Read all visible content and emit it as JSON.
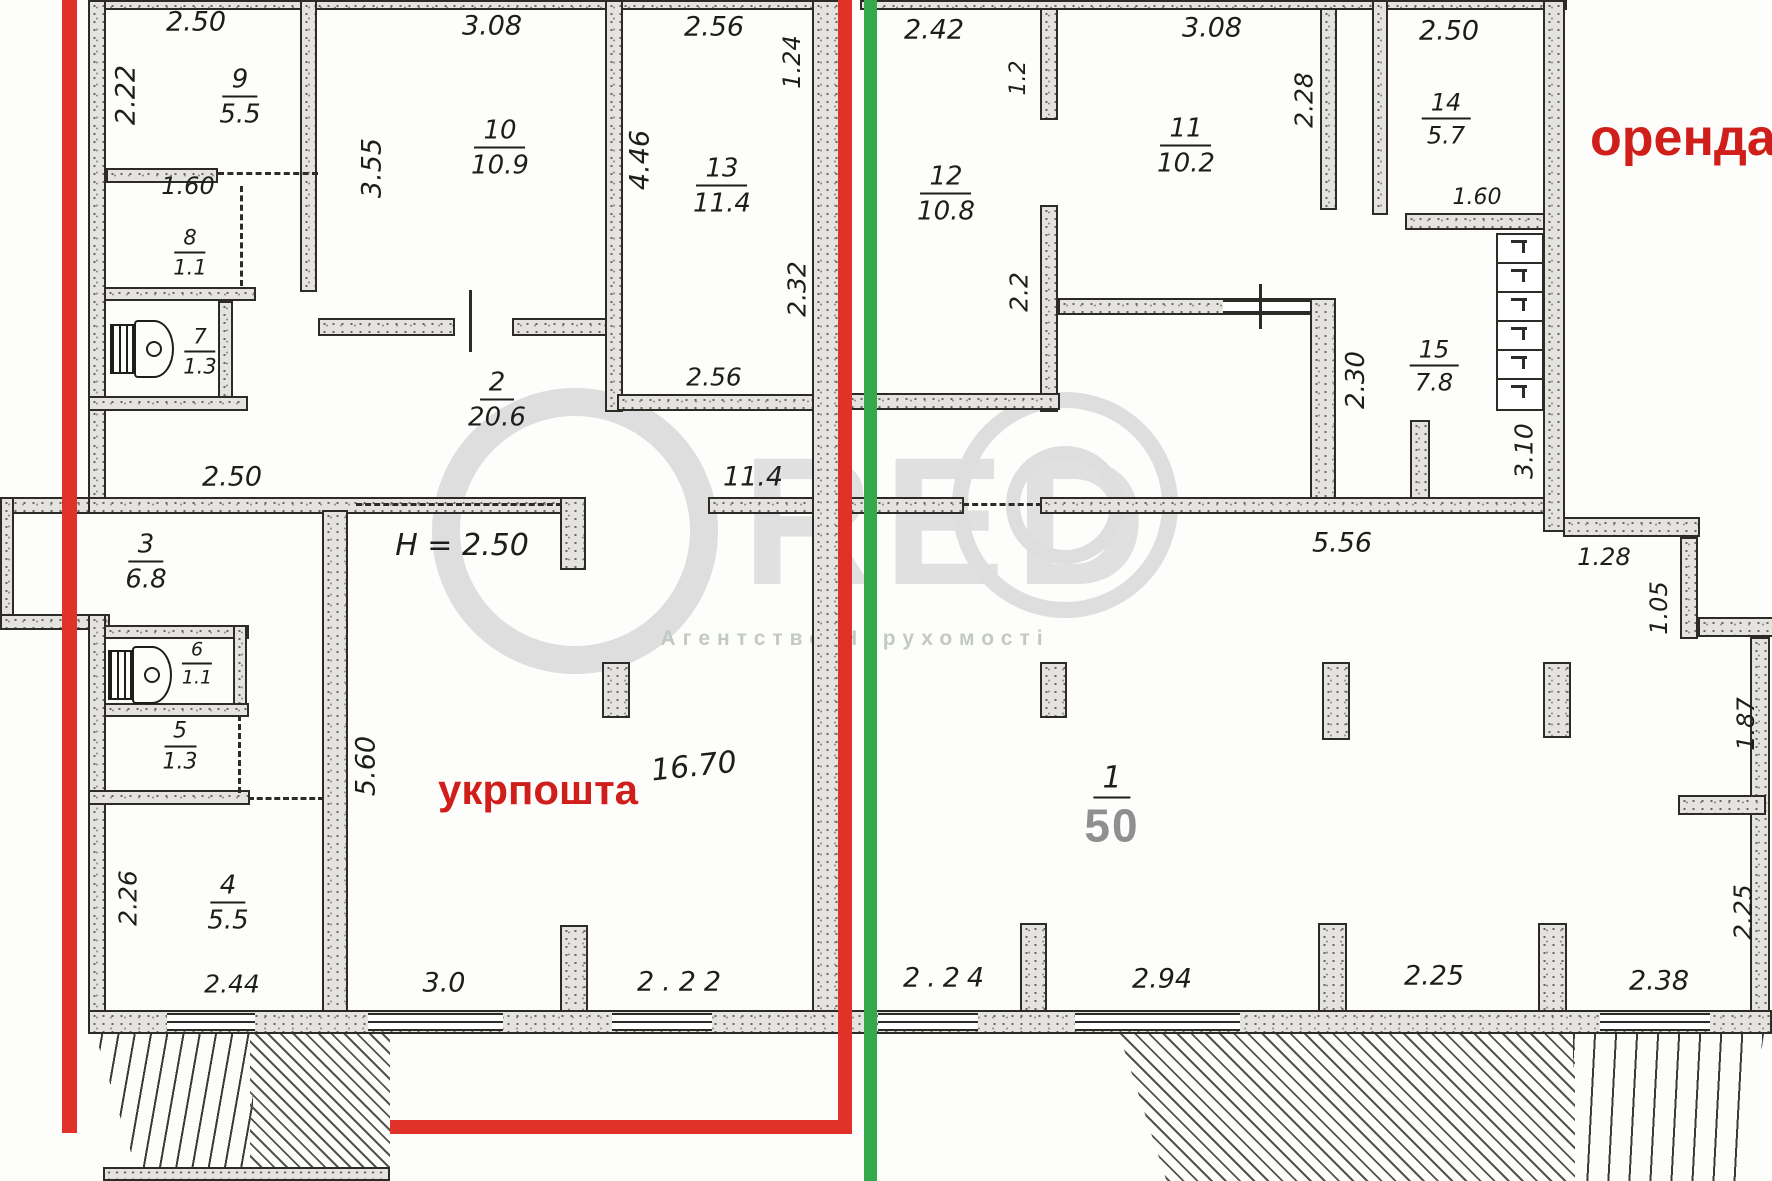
{
  "labels": {
    "ukrposhta": "укрпошта",
    "orenda": "оренда",
    "height_note": "H = 2.50"
  },
  "watermark": {
    "letters": "RED",
    "subtitle": "Агентство Нерухомості"
  },
  "rooms": {
    "r1": {
      "num": "1",
      "area": "50"
    },
    "r2": {
      "num": "2",
      "area": "20.6"
    },
    "r3": {
      "num": "3",
      "area": "6.8"
    },
    "r4": {
      "num": "4",
      "area": "5.5"
    },
    "r5": {
      "num": "5",
      "area": "1.3"
    },
    "r6": {
      "num": "6",
      "area": "1.1"
    },
    "r7": {
      "num": "7",
      "area": "1.3"
    },
    "r8": {
      "num": "8",
      "area": "1.1"
    },
    "r9": {
      "num": "9",
      "area": "5.5"
    },
    "r10": {
      "num": "10",
      "area": "10.9"
    },
    "r11": {
      "num": "11",
      "area": "10.2"
    },
    "r12": {
      "num": "12",
      "area": "10.8"
    },
    "r13": {
      "num": "13",
      "area": "11.4"
    },
    "r14": {
      "num": "14",
      "area": "5.7"
    },
    "r15": {
      "num": "15",
      "area": "7.8"
    }
  },
  "dims": {
    "w9_top": "2.50",
    "w9_left": "2.22",
    "w9_bottom": "1.60",
    "w10_top": "3.08",
    "w10_left": "3.55",
    "w13_top": "2.56",
    "w13_right_top": "1.24",
    "w13_left": "4.46",
    "w13_right_mid": "2.32",
    "w13_bottom": "2.56",
    "hall_250": "2.50",
    "hall_114": "11.4",
    "hall_560": "5.60",
    "hall_1670": "16.70",
    "r4_left": "2.26",
    "r4_bottom": "2.44",
    "bottom_30": "3.0",
    "bottom_222": "2.22",
    "w12_top": "2.42",
    "w12_stub": "1.2",
    "w11_top": "3.08",
    "w11_right": "2.28",
    "w14_top": "2.50",
    "w14_bottom": "1.60",
    "r15_gap": "2.2",
    "r15_left": "2.30",
    "stair_landing": "3.10",
    "right_556": "5.56",
    "right_128": "1.28",
    "right_105": "1.05",
    "right_187": "1.87",
    "right_225v": "2.25",
    "bottom_224": "2.24",
    "bottom_294": "2.94",
    "bottom_225": "2.25",
    "bottom_238": "2.38"
  },
  "colors": {
    "boundary_red": "#e03228",
    "divider_green": "#33a94c",
    "text_red": "#d01f1a",
    "area_gray": "#8f8f8f",
    "ink": "#1d1d1b"
  }
}
